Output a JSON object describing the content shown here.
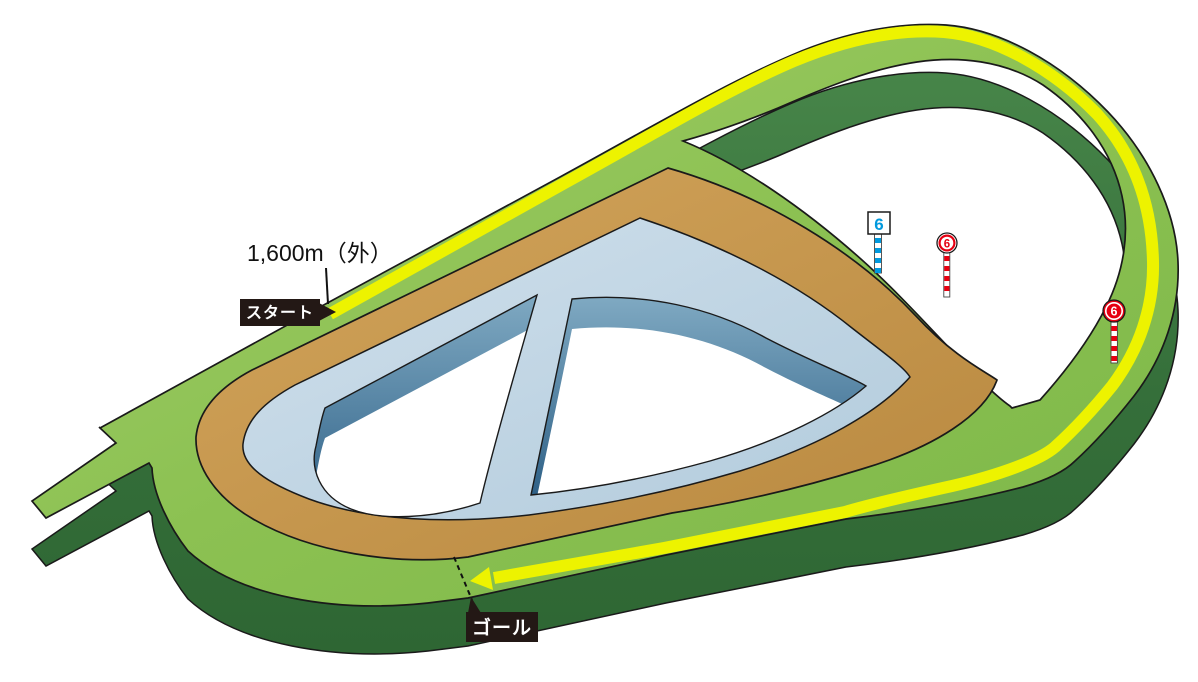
{
  "course_diagram": {
    "distance_label": "1,600m（外）",
    "start_tag": "スタート",
    "goal_tag": "ゴール",
    "furlong_markers": [
      {
        "label": "6",
        "style": "blue-square-sign"
      },
      {
        "label": "6",
        "style": "red-outlined-circle-sign"
      },
      {
        "label": "6",
        "style": "red-solid-circle-sign"
      }
    ],
    "colors": {
      "turf_green": "#8CC152",
      "turf_dark_side": "#2F6B35",
      "dirt_brown": "#C89B52",
      "inner_course_blue": "#C5D9E8",
      "inner_course_wall_blue": "#3E7095",
      "course_highlight_yellow": "#EDF300",
      "marker_red": "#E60012",
      "marker_blue": "#0099DD",
      "label_bg_black": "#231815"
    }
  }
}
